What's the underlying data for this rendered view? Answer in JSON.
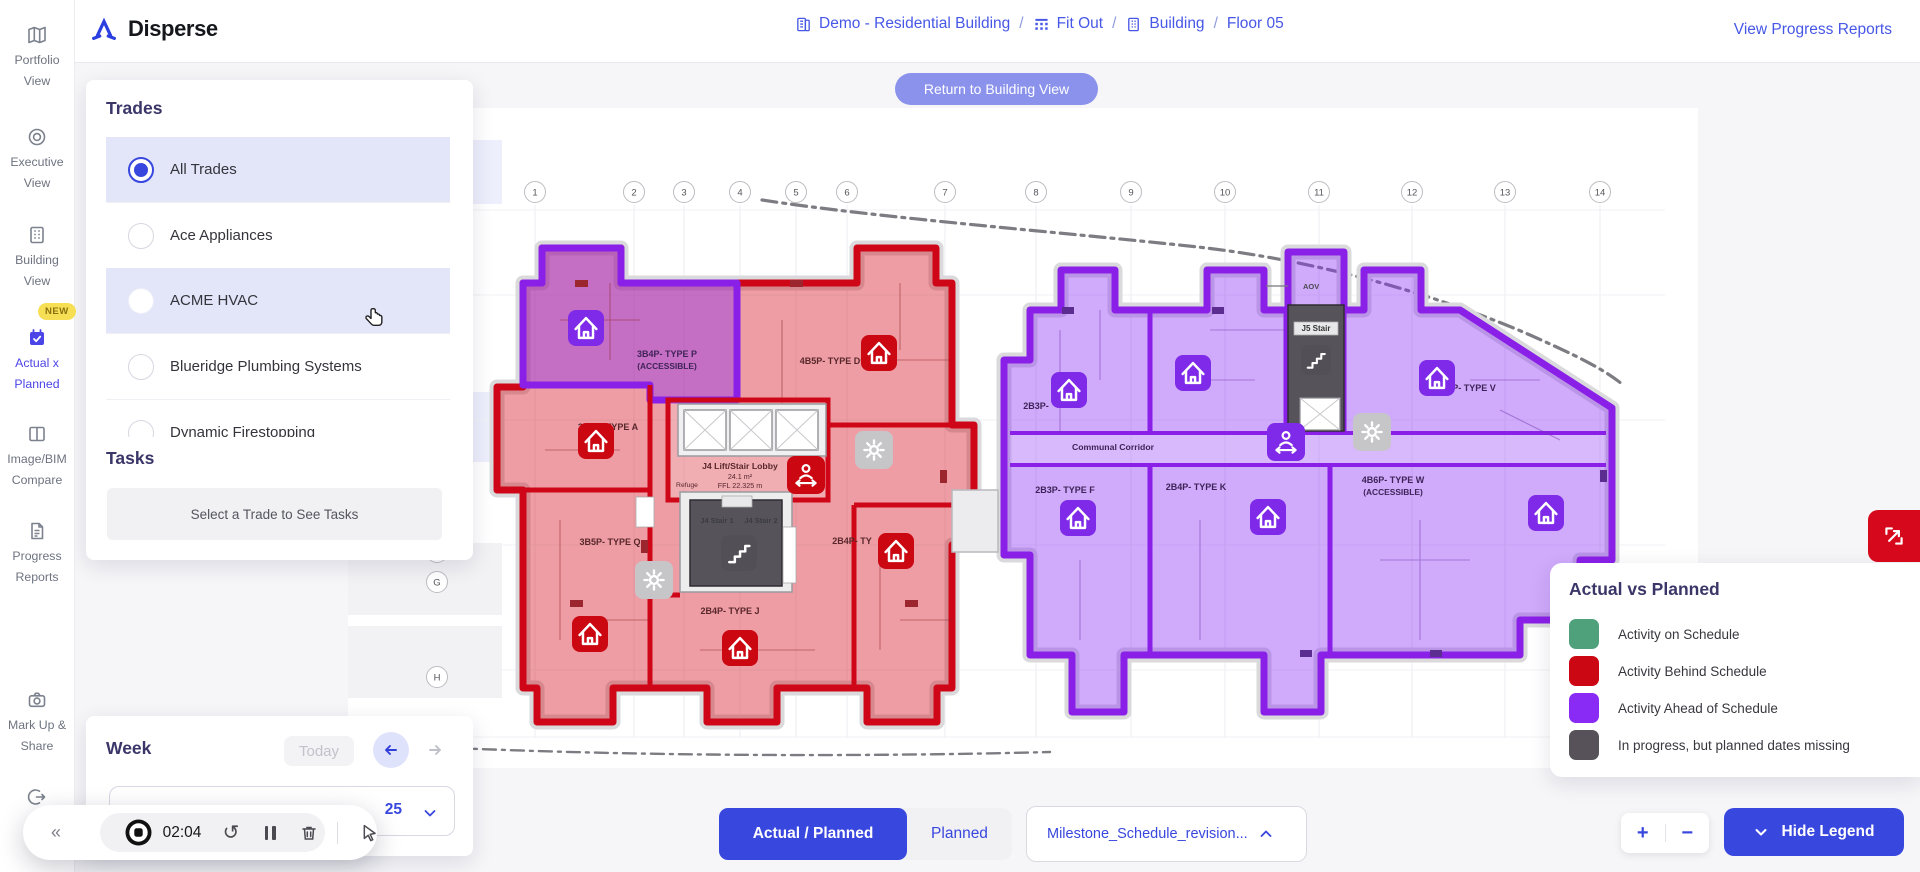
{
  "app": {
    "brand": "Disperse"
  },
  "header": {
    "breadcrumb": {
      "separator": "/",
      "items": [
        {
          "label": "Demo - Residential Building",
          "icon": "portfolio-building-icon"
        },
        {
          "label": "Fit Out",
          "icon": "phase-grid-icon"
        },
        {
          "label": "Building",
          "icon": "building-icon"
        },
        {
          "label": "Floor 05",
          "icon": ""
        }
      ]
    },
    "progress_link": "View Progress Reports"
  },
  "sidebar": {
    "items": [
      {
        "label": "Portfolio View",
        "icon": "map-icon"
      },
      {
        "label": "Executive View",
        "icon": "target-icon"
      },
      {
        "label": "Building View",
        "icon": "building-icon"
      },
      {
        "label": "Actual x Planned",
        "icon": "calendar-check-icon",
        "badge": "NEW",
        "active": true
      },
      {
        "label": "Image/BIM Compare",
        "icon": "split-view-icon"
      },
      {
        "label": "Progress Reports",
        "icon": "report-icon"
      },
      {
        "label": "Mark Up & Share",
        "icon": "camera-icon"
      },
      {
        "label": "Lo",
        "icon": "logout-icon"
      }
    ]
  },
  "trades": {
    "title": "Trades",
    "options": [
      {
        "label": "All Trades",
        "selected": true,
        "highlighted": true
      },
      {
        "label": "Ace Appliances",
        "selected": false,
        "highlighted": false
      },
      {
        "label": "ACME HVAC",
        "selected": false,
        "highlighted": true
      },
      {
        "label": "Blueridge Plumbing Systems",
        "selected": false,
        "highlighted": false
      },
      {
        "label": "Dynamic Firestopping",
        "selected": false,
        "highlighted": false
      }
    ],
    "tasks_title": "Tasks",
    "tasks_placeholder": "Select a Trade to See Tasks"
  },
  "week": {
    "title": "Week",
    "today": "Today",
    "date_fragment": "25"
  },
  "canvas": {
    "return_button": "Return to Building View"
  },
  "plan": {
    "grid_cols": [
      "1",
      "2",
      "3",
      "4",
      "5",
      "6",
      "7",
      "8",
      "9",
      "10",
      "11",
      "12",
      "13",
      "14"
    ],
    "grid_rows": [
      "E",
      "F",
      "G",
      "H"
    ],
    "labels": {
      "unit_p": "3B4P- TYPE P",
      "unit_p_sub": "(ACCESSIBLE)",
      "unit_d": "4B5P- TYPE D",
      "unit_a": "3B5P- TYPE A",
      "unit_q": "3B5P- TYPE Q",
      "unit_j": "2B4P- TYPE J",
      "unit_ty": "2B4P- TY",
      "lobby": "J4 Lift/Stair Lobby",
      "lobby_area": "24.1 m²",
      "lobby_ffl": "FFL 22.325 m",
      "refuge": "Refuge",
      "stair1": "J4 Stair 1",
      "stair2": "J4 Stair 2",
      "unit_2b3p": "2B3P-",
      "corridor": "Communal Corridor",
      "unit_f": "2B3P- TYPE F",
      "unit_k": "2B4P- TYPE K",
      "unit_w": "4B6P- TYPE W",
      "unit_w_sub": "(ACCESSIBLE)",
      "unit_v": "P- TYPE V",
      "stair_j5": "J5 Stair",
      "aov": "AOV"
    }
  },
  "recording": {
    "time": "02:04"
  },
  "legend": {
    "title": "Actual vs Planned",
    "items": [
      {
        "label": "Activity on Schedule",
        "color": "#4FA17C"
      },
      {
        "label": "Activity Behind Schedule",
        "color": "#CB0713"
      },
      {
        "label": "Activity Ahead of Schedule",
        "color": "#8A2BF5"
      },
      {
        "label": "In progress, but planned dates missing",
        "color": "#57525A"
      }
    ]
  },
  "footer": {
    "toggle_actual": "Actual / Planned",
    "toggle_planned": "Planned",
    "schedule_dropdown": "Milestone_Schedule_revision...",
    "hide_legend": "Hide Legend",
    "zoom_in": "+",
    "zoom_out": "−"
  },
  "colors": {
    "primary": "#3847DE",
    "link": "#4757E6",
    "highlight_row": "#E3E5F8",
    "status_green": "#4FA17C",
    "status_red": "#CB0713",
    "status_purple": "#8A2BF5",
    "status_dark": "#57525A",
    "new_badge": "#F6DF55"
  },
  "icons": {
    "sidebar": [
      "map-icon",
      "target-icon",
      "building-icon",
      "calendar-check-icon",
      "split-view-icon",
      "report-icon",
      "camera-icon",
      "logout-icon"
    ],
    "plan": [
      "home-icon",
      "gear-icon",
      "stairs-icon",
      "person-width-icon"
    ],
    "controls": [
      "collapse-left-icon",
      "record-stop-icon",
      "restart-icon",
      "pause-icon",
      "trash-icon",
      "pointer-icon",
      "arrow-left-icon",
      "arrow-right-icon",
      "chevron-down-icon",
      "chevron-up-icon",
      "plus-icon",
      "minus-icon",
      "expand-icon"
    ]
  }
}
